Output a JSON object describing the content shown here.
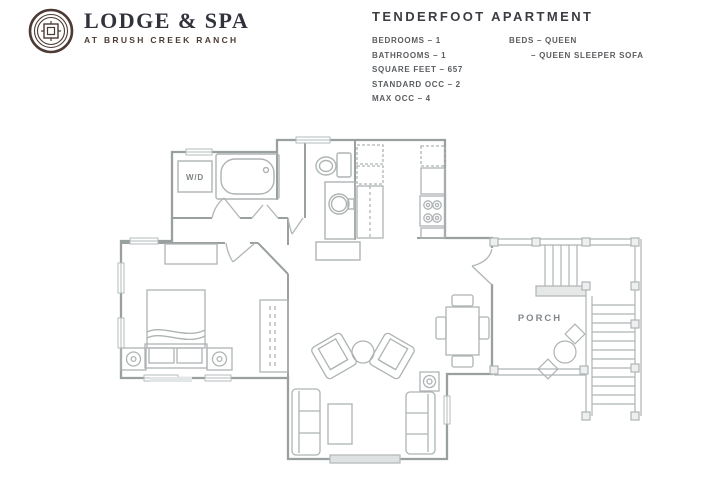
{
  "brand": {
    "name": "LODGE & SPA",
    "tagline": "AT BRUSH CREEK RANCH"
  },
  "unit": {
    "title": "TENDERFOOT APARTMENT",
    "specs": [
      "BEDROOMS – 1",
      "BATHROOMS – 1",
      "SQUARE FEET – 657",
      "STANDARD OCC – 2",
      "MAX OCC – 4"
    ],
    "beds": [
      "BEDS – QUEEN",
      "– QUEEN SLEEPER SOFA"
    ]
  },
  "floorplan": {
    "labels": {
      "washer_dryer": "W/D",
      "porch": "PORCH"
    }
  },
  "colors": {
    "brand_emblem": "#4d3a34",
    "brand_text": "#32323c",
    "tagline": "#4d3b33",
    "plan_wall": "#9aa0a0",
    "plan_fixture": "#aeb3b3"
  }
}
